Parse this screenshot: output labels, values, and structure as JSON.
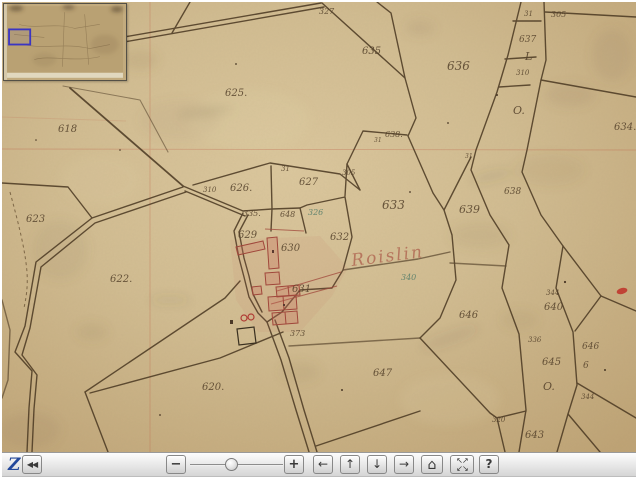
{
  "toolbar": {
    "logo": "Z",
    "slider_position_pct": 45,
    "buttons": {
      "collapse": "◀◀",
      "zoom_out": "−",
      "zoom_in": "+",
      "pan_left": "←",
      "pan_up": "↑",
      "pan_down": "↓",
      "pan_right": "→",
      "reset": "⌂",
      "expand_row1": "↖↗",
      "expand_row2": "↙↘",
      "help": "?"
    }
  },
  "navigator": {
    "view_rect": {
      "x": 5,
      "y": 25,
      "w": 21,
      "h": 15
    }
  },
  "map": {
    "colors": {
      "paper": "#d2bd92",
      "ink": "#53402a",
      "red": "#a8564a",
      "teal": "#4f7a68",
      "grid_pink": "#c06a50",
      "view_rect_blue": "#3b35c2"
    },
    "place_name": "Roislin",
    "labels": [
      {
        "t": "327",
        "x": 319,
        "y": 14,
        "s": 8,
        "o": 0.65
      },
      {
        "t": "635",
        "x": 362,
        "y": 54,
        "s": 10
      },
      {
        "t": "625.",
        "x": 225,
        "y": 96,
        "s": 10
      },
      {
        "t": "618",
        "x": 58,
        "y": 132,
        "s": 10
      },
      {
        "t": "623",
        "x": 26,
        "y": 222,
        "s": 10
      },
      {
        "t": "622.",
        "x": 110,
        "y": 282,
        "s": 10
      },
      {
        "t": "620.",
        "x": 202,
        "y": 390,
        "s": 10
      },
      {
        "t": "310",
        "x": 203,
        "y": 192,
        "s": 7,
        "o": 0.6
      },
      {
        "t": "626.",
        "x": 230,
        "y": 191,
        "s": 10
      },
      {
        "t": "31",
        "x": 281,
        "y": 171,
        "s": 7,
        "o": 0.6
      },
      {
        "t": "627",
        "x": 299,
        "y": 185,
        "s": 10
      },
      {
        "t": "335.",
        "x": 243,
        "y": 216,
        "s": 8,
        "o": 0.7
      },
      {
        "t": "648",
        "x": 280,
        "y": 217,
        "s": 8
      },
      {
        "t": "326",
        "x": 308,
        "y": 215,
        "s": 8,
        "c": "#4f7a68"
      },
      {
        "t": "629",
        "x": 238,
        "y": 238,
        "s": 10
      },
      {
        "t": "630",
        "x": 281,
        "y": 251,
        "s": 10
      },
      {
        "t": "632",
        "x": 330,
        "y": 240,
        "s": 10
      },
      {
        "t": "633",
        "x": 382,
        "y": 209,
        "s": 12
      },
      {
        "t": "631",
        "x": 292,
        "y": 292,
        "s": 10
      },
      {
        "t": "Roislin",
        "x": 352,
        "y": 266,
        "s": 17,
        "c": "rgba(168,82,66,0.78)",
        "r": -7,
        "k": "cursive",
        "ls": "2",
        "n": "place-name-label"
      },
      {
        "t": "305",
        "x": 342,
        "y": 175,
        "s": 7,
        "o": 0.6
      },
      {
        "t": "638.",
        "x": 385,
        "y": 137,
        "s": 8
      },
      {
        "t": "31",
        "x": 374,
        "y": 142,
        "s": 6,
        "o": 0.55
      },
      {
        "t": "373",
        "x": 290,
        "y": 336,
        "s": 8,
        "o": 0.7
      },
      {
        "t": "647",
        "x": 373,
        "y": 376,
        "s": 10
      },
      {
        "t": "636",
        "x": 447,
        "y": 70,
        "s": 12
      },
      {
        "t": "637",
        "x": 519,
        "y": 42,
        "s": 9
      },
      {
        "t": "L",
        "x": 525,
        "y": 60,
        "s": 11,
        "k": "cursive"
      },
      {
        "t": "310",
        "x": 516,
        "y": 75,
        "s": 7,
        "o": 0.6
      },
      {
        "t": "31",
        "x": 524,
        "y": 16,
        "s": 7,
        "o": 0.6
      },
      {
        "t": "305",
        "x": 551,
        "y": 17,
        "s": 8,
        "o": 0.7
      },
      {
        "t": "634.",
        "x": 614,
        "y": 130,
        "s": 10
      },
      {
        "t": "O.",
        "x": 513,
        "y": 114,
        "s": 11,
        "k": "cursive"
      },
      {
        "t": "639",
        "x": 459,
        "y": 213,
        "s": 11
      },
      {
        "t": "638",
        "x": 504,
        "y": 194,
        "s": 9
      },
      {
        "t": "31",
        "x": 465,
        "y": 158,
        "s": 6,
        "o": 0.55
      },
      {
        "t": "646",
        "x": 459,
        "y": 318,
        "s": 10
      },
      {
        "t": "344",
        "x": 546,
        "y": 295,
        "s": 7,
        "o": 0.6
      },
      {
        "t": "640",
        "x": 544,
        "y": 310,
        "s": 10
      },
      {
        "t": "336",
        "x": 528,
        "y": 342,
        "s": 7,
        "o": 0.6
      },
      {
        "t": "645",
        "x": 542,
        "y": 365,
        "s": 10
      },
      {
        "t": "O.",
        "x": 543,
        "y": 390,
        "s": 11,
        "k": "cursive"
      },
      {
        "t": "646",
        "x": 582,
        "y": 349,
        "s": 9
      },
      {
        "t": "6",
        "x": 583,
        "y": 368,
        "s": 9
      },
      {
        "t": "344",
        "x": 581,
        "y": 399,
        "s": 7,
        "o": 0.6
      },
      {
        "t": "320",
        "x": 492,
        "y": 422,
        "s": 7,
        "o": 0.6
      },
      {
        "t": "643",
        "x": 525,
        "y": 438,
        "s": 10
      },
      {
        "t": "340",
        "x": 401,
        "y": 280,
        "s": 8,
        "c": "#4f7a68",
        "o": 0.8
      }
    ]
  }
}
